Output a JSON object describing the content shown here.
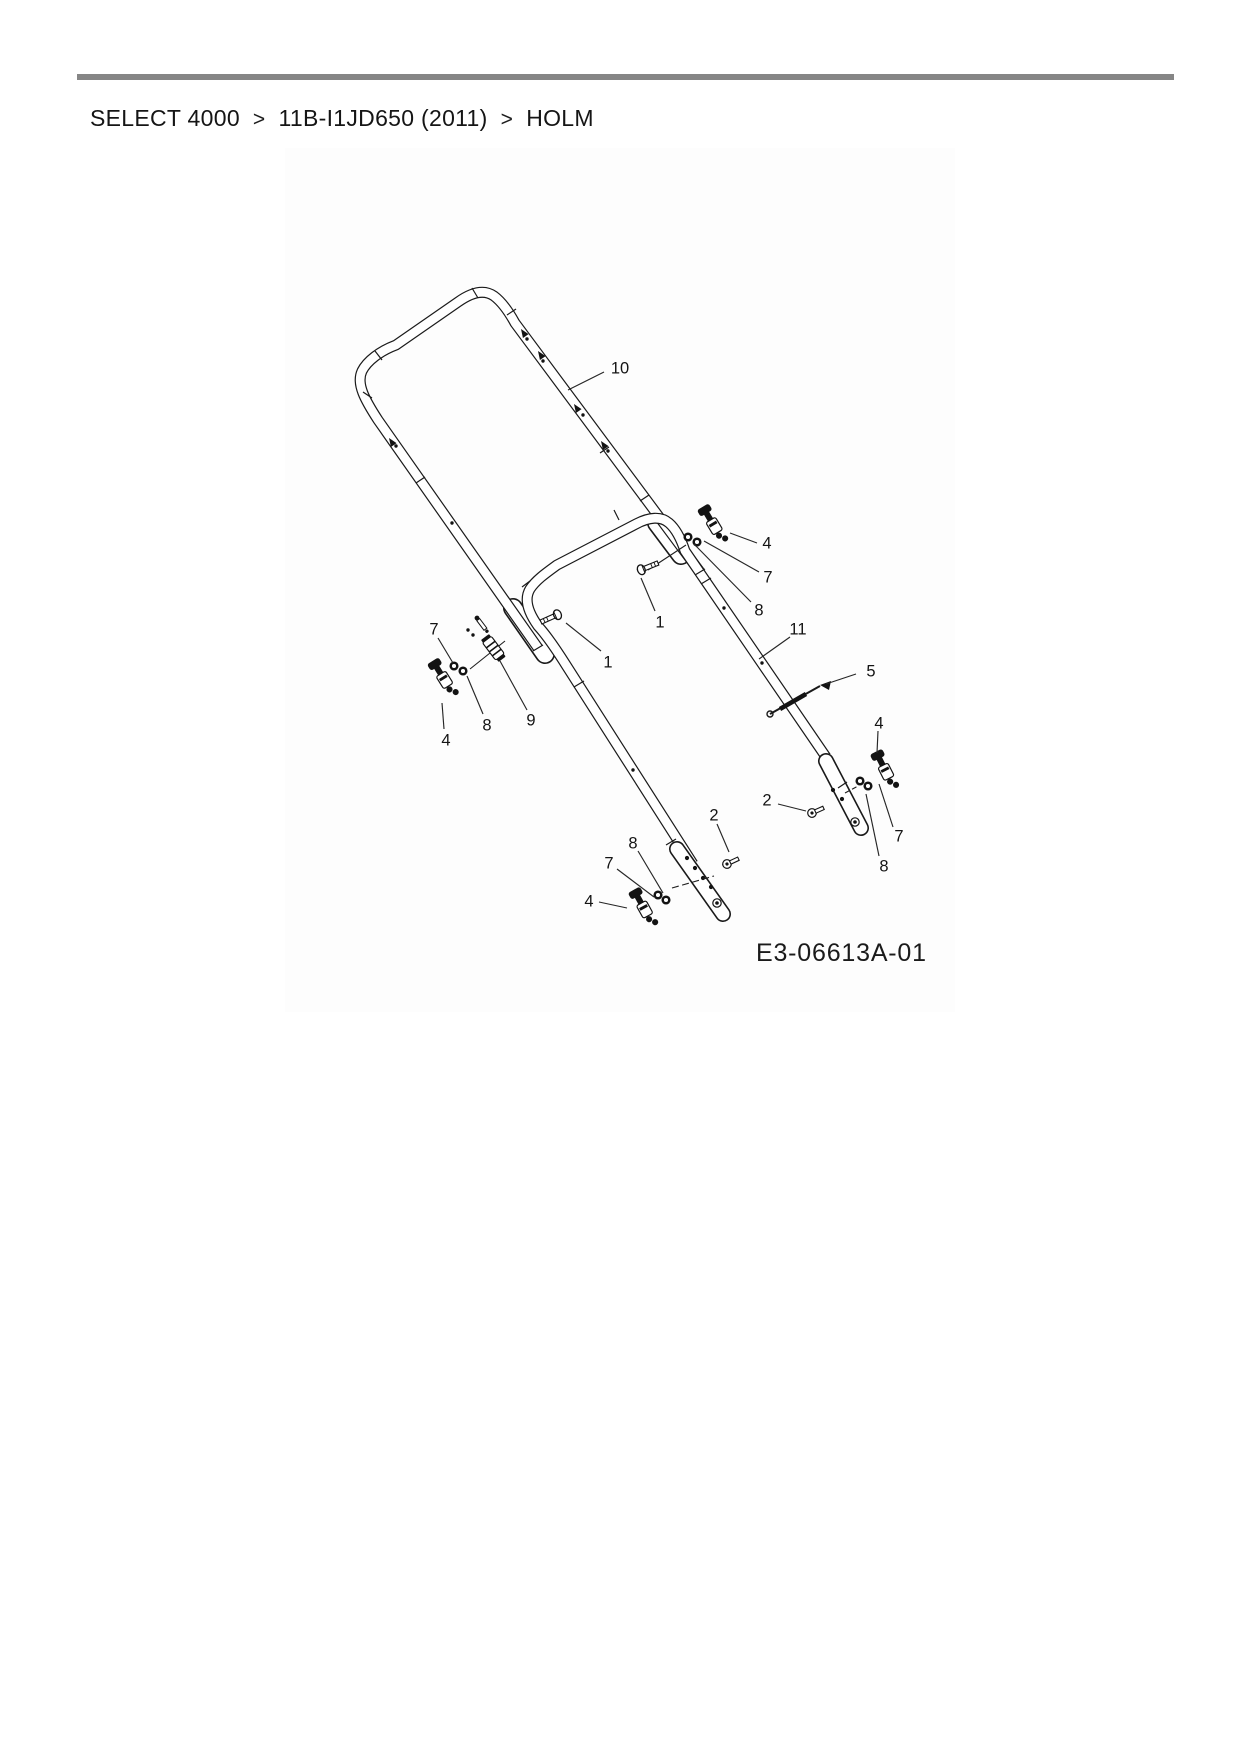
{
  "page": {
    "background": "#ffffff"
  },
  "header": {
    "rule_color": "#868686",
    "breadcrumb": {
      "separator": ">",
      "items": [
        {
          "label": "SELECT 4000"
        },
        {
          "label": "11B-I1JD650 (2011)"
        },
        {
          "label": "HOLM"
        }
      ]
    }
  },
  "diagram": {
    "title": "HOLM (handle bar exploded parts view)",
    "part_code": "E3-06613A-01",
    "ink_color": "#1a1a1a",
    "callouts": [
      {
        "label": "10",
        "cx": 620,
        "cy": 368,
        "x1": 604,
        "y1": 372,
        "x2": 568,
        "y2": 390
      },
      {
        "label": "1",
        "cx": 608,
        "cy": 662,
        "x1": 601,
        "y1": 651,
        "x2": 566,
        "y2": 623
      },
      {
        "label": "1",
        "cx": 660,
        "cy": 622,
        "x1": 655,
        "y1": 611,
        "x2": 641,
        "y2": 578
      },
      {
        "label": "4",
        "cx": 767,
        "cy": 543,
        "x1": 757,
        "y1": 543,
        "x2": 730,
        "y2": 533
      },
      {
        "label": "7",
        "cx": 768,
        "cy": 577,
        "x1": 759,
        "y1": 572,
        "x2": 704,
        "y2": 541
      },
      {
        "label": "8",
        "cx": 759,
        "cy": 610,
        "x1": 751,
        "y1": 602,
        "x2": 694,
        "y2": 544
      },
      {
        "label": "11",
        "cx": 798,
        "cy": 629,
        "x1": 790,
        "y1": 637,
        "x2": 759,
        "y2": 659
      },
      {
        "label": "5",
        "cx": 871,
        "cy": 671,
        "x1": 856,
        "y1": 674,
        "x2": 826,
        "y2": 684
      },
      {
        "label": "4",
        "cx": 879,
        "cy": 723,
        "x1": 878,
        "y1": 731,
        "x2": 877,
        "y2": 753
      },
      {
        "label": "7",
        "cx": 899,
        "cy": 836,
        "x1": 893,
        "y1": 827,
        "x2": 879,
        "y2": 784
      },
      {
        "label": "8",
        "cx": 884,
        "cy": 866,
        "x1": 879,
        "y1": 856,
        "x2": 866,
        "y2": 794
      },
      {
        "label": "2",
        "cx": 767,
        "cy": 800,
        "x1": 778,
        "y1": 804,
        "x2": 806,
        "y2": 811
      },
      {
        "label": "2",
        "cx": 714,
        "cy": 815,
        "x1": 717,
        "y1": 824,
        "x2": 729,
        "y2": 852
      },
      {
        "label": "8",
        "cx": 633,
        "cy": 843,
        "x1": 638,
        "y1": 851,
        "x2": 663,
        "y2": 893
      },
      {
        "label": "7",
        "cx": 609,
        "cy": 863,
        "x1": 617,
        "y1": 869,
        "x2": 654,
        "y2": 897
      },
      {
        "label": "4",
        "cx": 589,
        "cy": 901,
        "x1": 599,
        "y1": 902,
        "x2": 627,
        "y2": 908
      },
      {
        "label": "7",
        "cx": 434,
        "cy": 629,
        "x1": 438,
        "y1": 638,
        "x2": 453,
        "y2": 663
      },
      {
        "label": "8",
        "cx": 487,
        "cy": 725,
        "x1": 483,
        "y1": 714,
        "x2": 467,
        "y2": 676
      },
      {
        "label": "9",
        "cx": 531,
        "cy": 720,
        "x1": 527,
        "y1": 710,
        "x2": 500,
        "y2": 661
      },
      {
        "label": "4",
        "cx": 446,
        "cy": 740,
        "x1": 444,
        "y1": 729,
        "x2": 442,
        "y2": 703
      }
    ]
  }
}
